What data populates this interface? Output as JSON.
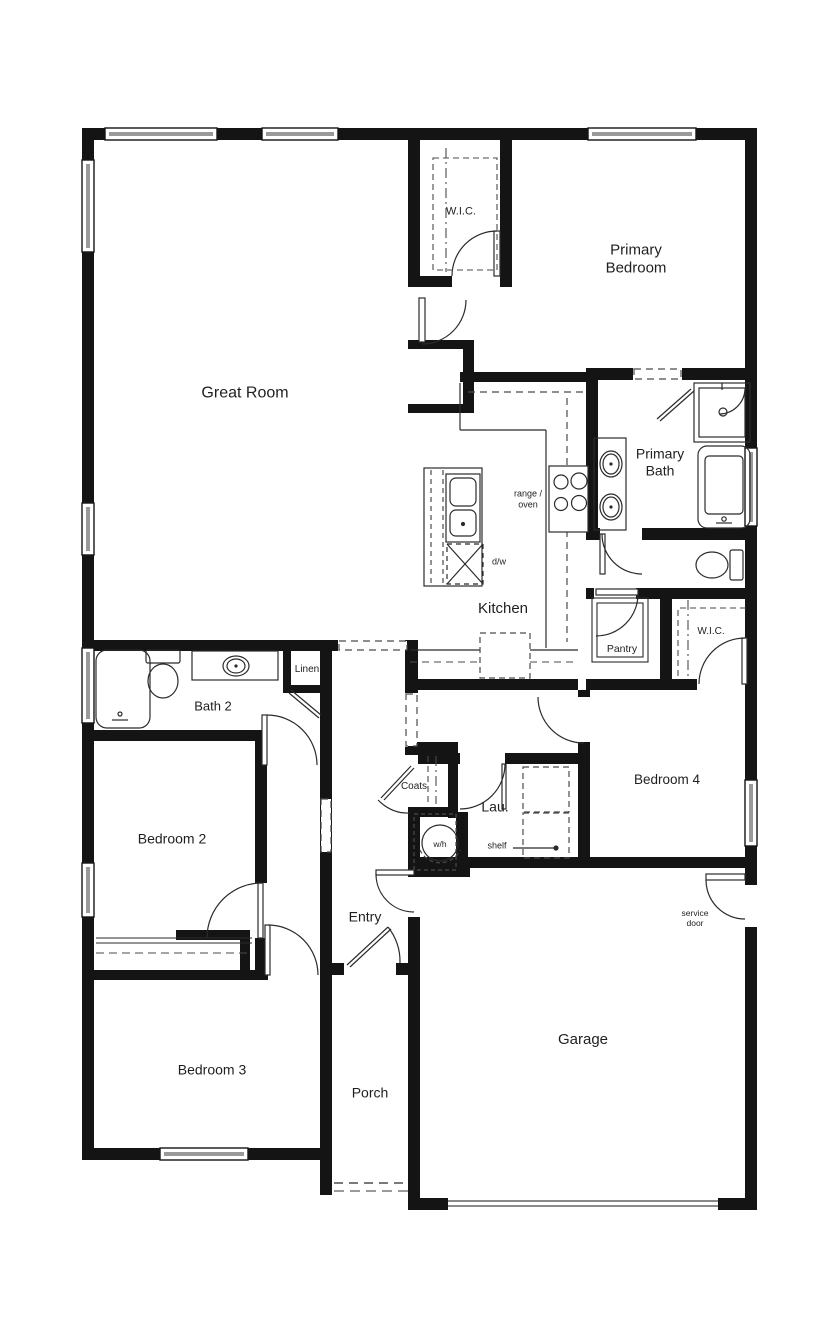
{
  "document": {
    "kind": "floor-plan"
  },
  "colors": {
    "wall": "#141414",
    "line": "#2b2b2b",
    "window_glass": "#9a9a9a",
    "dash": "#4a4a4a",
    "text": "#1f1f1f",
    "background": "#ffffff"
  },
  "labels": [
    {
      "id": "great-room",
      "lines": [
        "Great Room"
      ],
      "x": 245,
      "y": 394,
      "fs": 16
    },
    {
      "id": "wic-primary",
      "lines": [
        "W.I.C."
      ],
      "x": 461,
      "y": 212,
      "fs": 11
    },
    {
      "id": "primary-bedroom",
      "lines": [
        "Primary",
        "Bedroom"
      ],
      "x": 636,
      "y": 259,
      "fs": 15
    },
    {
      "id": "primary-bath",
      "lines": [
        "Primary",
        "Bath"
      ],
      "x": 660,
      "y": 462,
      "fs": 14
    },
    {
      "id": "range-oven",
      "lines": [
        "range /",
        "oven"
      ],
      "x": 528,
      "y": 499,
      "fs": 9
    },
    {
      "id": "dishwasher",
      "lines": [
        "d/w"
      ],
      "x": 499,
      "y": 562,
      "fs": 9
    },
    {
      "id": "kitchen",
      "lines": [
        "Kitchen"
      ],
      "x": 503,
      "y": 609,
      "fs": 15
    },
    {
      "id": "pantry",
      "lines": [
        "Pantry"
      ],
      "x": 622,
      "y": 649,
      "fs": 10.5
    },
    {
      "id": "wic-bedroom4",
      "lines": [
        "W.I.C."
      ],
      "x": 711,
      "y": 632,
      "fs": 10
    },
    {
      "id": "linen",
      "lines": [
        "Linen"
      ],
      "x": 307,
      "y": 670,
      "fs": 10
    },
    {
      "id": "bath-2",
      "lines": [
        "Bath 2"
      ],
      "x": 213,
      "y": 706,
      "fs": 13
    },
    {
      "id": "bedroom-2",
      "lines": [
        "Bedroom 2"
      ],
      "x": 172,
      "y": 839,
      "fs": 14
    },
    {
      "id": "coats",
      "lines": [
        "Coats"
      ],
      "x": 414,
      "y": 787,
      "fs": 10
    },
    {
      "id": "laundry",
      "lines": [
        "Lau."
      ],
      "x": 495,
      "y": 807,
      "fs": 14
    },
    {
      "id": "water-heater",
      "lines": [
        "w/h"
      ],
      "x": 440,
      "y": 844,
      "fs": 8.5
    },
    {
      "id": "shelf",
      "lines": [
        "shelf"
      ],
      "x": 497,
      "y": 846,
      "fs": 9
    },
    {
      "id": "bedroom-4",
      "lines": [
        "Bedroom 4"
      ],
      "x": 667,
      "y": 780,
      "fs": 13.5
    },
    {
      "id": "entry",
      "lines": [
        "Entry"
      ],
      "x": 365,
      "y": 917,
      "fs": 14
    },
    {
      "id": "service-door",
      "lines": [
        "service",
        "door"
      ],
      "x": 695,
      "y": 918,
      "fs": 8.5
    },
    {
      "id": "garage",
      "lines": [
        "Garage"
      ],
      "x": 583,
      "y": 1040,
      "fs": 15
    },
    {
      "id": "bedroom-3",
      "lines": [
        "Bedroom 3"
      ],
      "x": 212,
      "y": 1070,
      "fs": 14
    },
    {
      "id": "porch",
      "lines": [
        "Porch"
      ],
      "x": 370,
      "y": 1093,
      "fs": 14
    }
  ],
  "fixture_icons": [
    "bathtub-icon",
    "toilet-icon",
    "sink-icon",
    "shower-icon",
    "range-oven-icon",
    "dishwasher-icon",
    "kitchen-island-icon",
    "water-heater-icon",
    "washer-dryer-space-icon",
    "garage-door-icon",
    "front-door-icon",
    "service-door-icon",
    "window-icon",
    "door-swing-icon"
  ]
}
